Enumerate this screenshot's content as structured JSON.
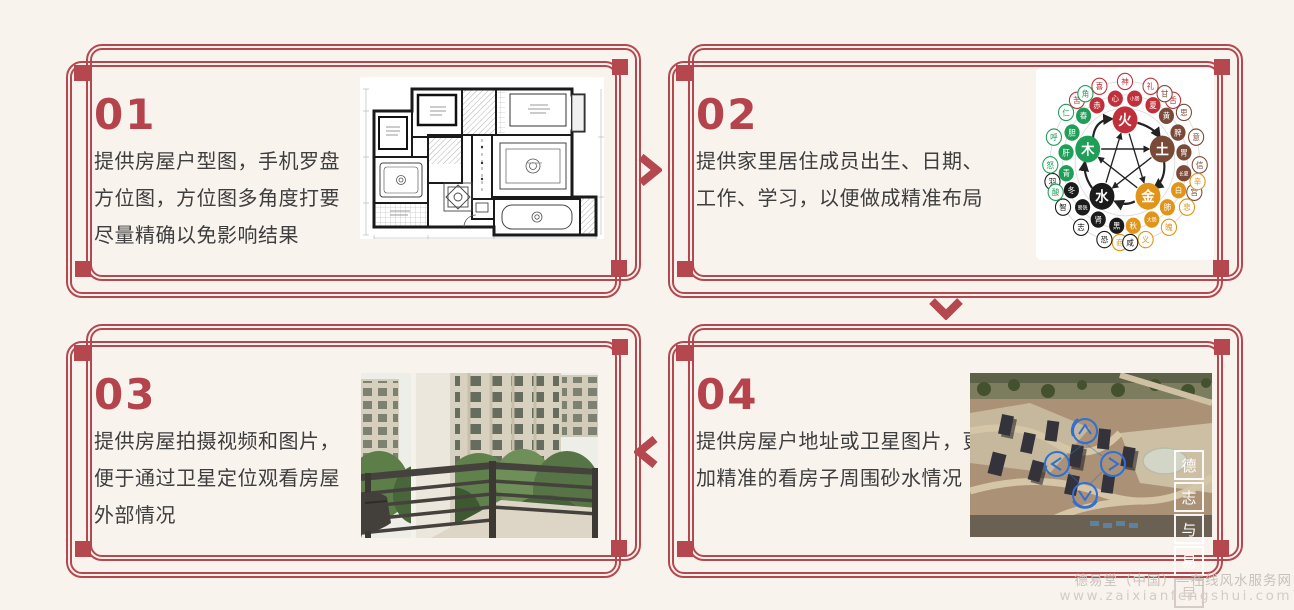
{
  "page": {
    "background": "#f9f3ee",
    "accent": "#b5474e"
  },
  "steps": [
    {
      "number": "01",
      "lines": [
        "提供房屋户型图，手机罗盘",
        "方位图，方位图多角度打要",
        "尽量精确以免影响结果"
      ],
      "image": "floor-plan"
    },
    {
      "number": "02",
      "lines": [
        "提供家里居住成员出生、日期、",
        "工作、学习，以便做成精准布局"
      ],
      "image": "five-elements-diagram"
    },
    {
      "number": "03",
      "lines": [
        "提供房屋拍摄视频和图片，",
        "便于通过卫星定位观看房屋",
        "外部情况"
      ],
      "image": "balcony-photo"
    },
    {
      "number": "04",
      "lines": [
        "提供房屋户地址或卫星图片，更",
        "加精准的看房子周围砂水情况"
      ],
      "image": "satellite-photo"
    }
  ],
  "wuxing": {
    "elements": [
      {
        "name": "火",
        "color": "#c0303a",
        "satellites": [
          "苦",
          "喜",
          "神",
          "礼",
          "舌",
          "赤",
          "心",
          "小肠",
          "夏"
        ]
      },
      {
        "name": "土",
        "color": "#7a4a38",
        "satellites": [
          "甘",
          "思",
          "意",
          "信",
          "宫",
          "黄",
          "脾",
          "胃",
          "长夏"
        ]
      },
      {
        "name": "金",
        "color": "#e09418",
        "satellites": [
          "辛",
          "悲",
          "魄",
          "义",
          "商",
          "白",
          "肺",
          "大肠",
          "秋"
        ]
      },
      {
        "name": "水",
        "color": "#1b1b1b",
        "satellites": [
          "咸",
          "恐",
          "志",
          "智",
          "羽",
          "黑",
          "肾",
          "膀胱",
          "冬"
        ]
      },
      {
        "name": "木",
        "color": "#1f9e57",
        "satellites": [
          "酸",
          "怒",
          "呼",
          "仁",
          "角",
          "青",
          "肝",
          "胆",
          "春"
        ]
      }
    ]
  },
  "satellite_watermark": {
    "chars": [
      "德",
      "志",
      "与",
      "易",
      "早"
    ]
  },
  "footer_watermark": {
    "line1": "德易堂（中国）—在线风水服务网",
    "line2": "www.zaixianfengshui.com"
  }
}
